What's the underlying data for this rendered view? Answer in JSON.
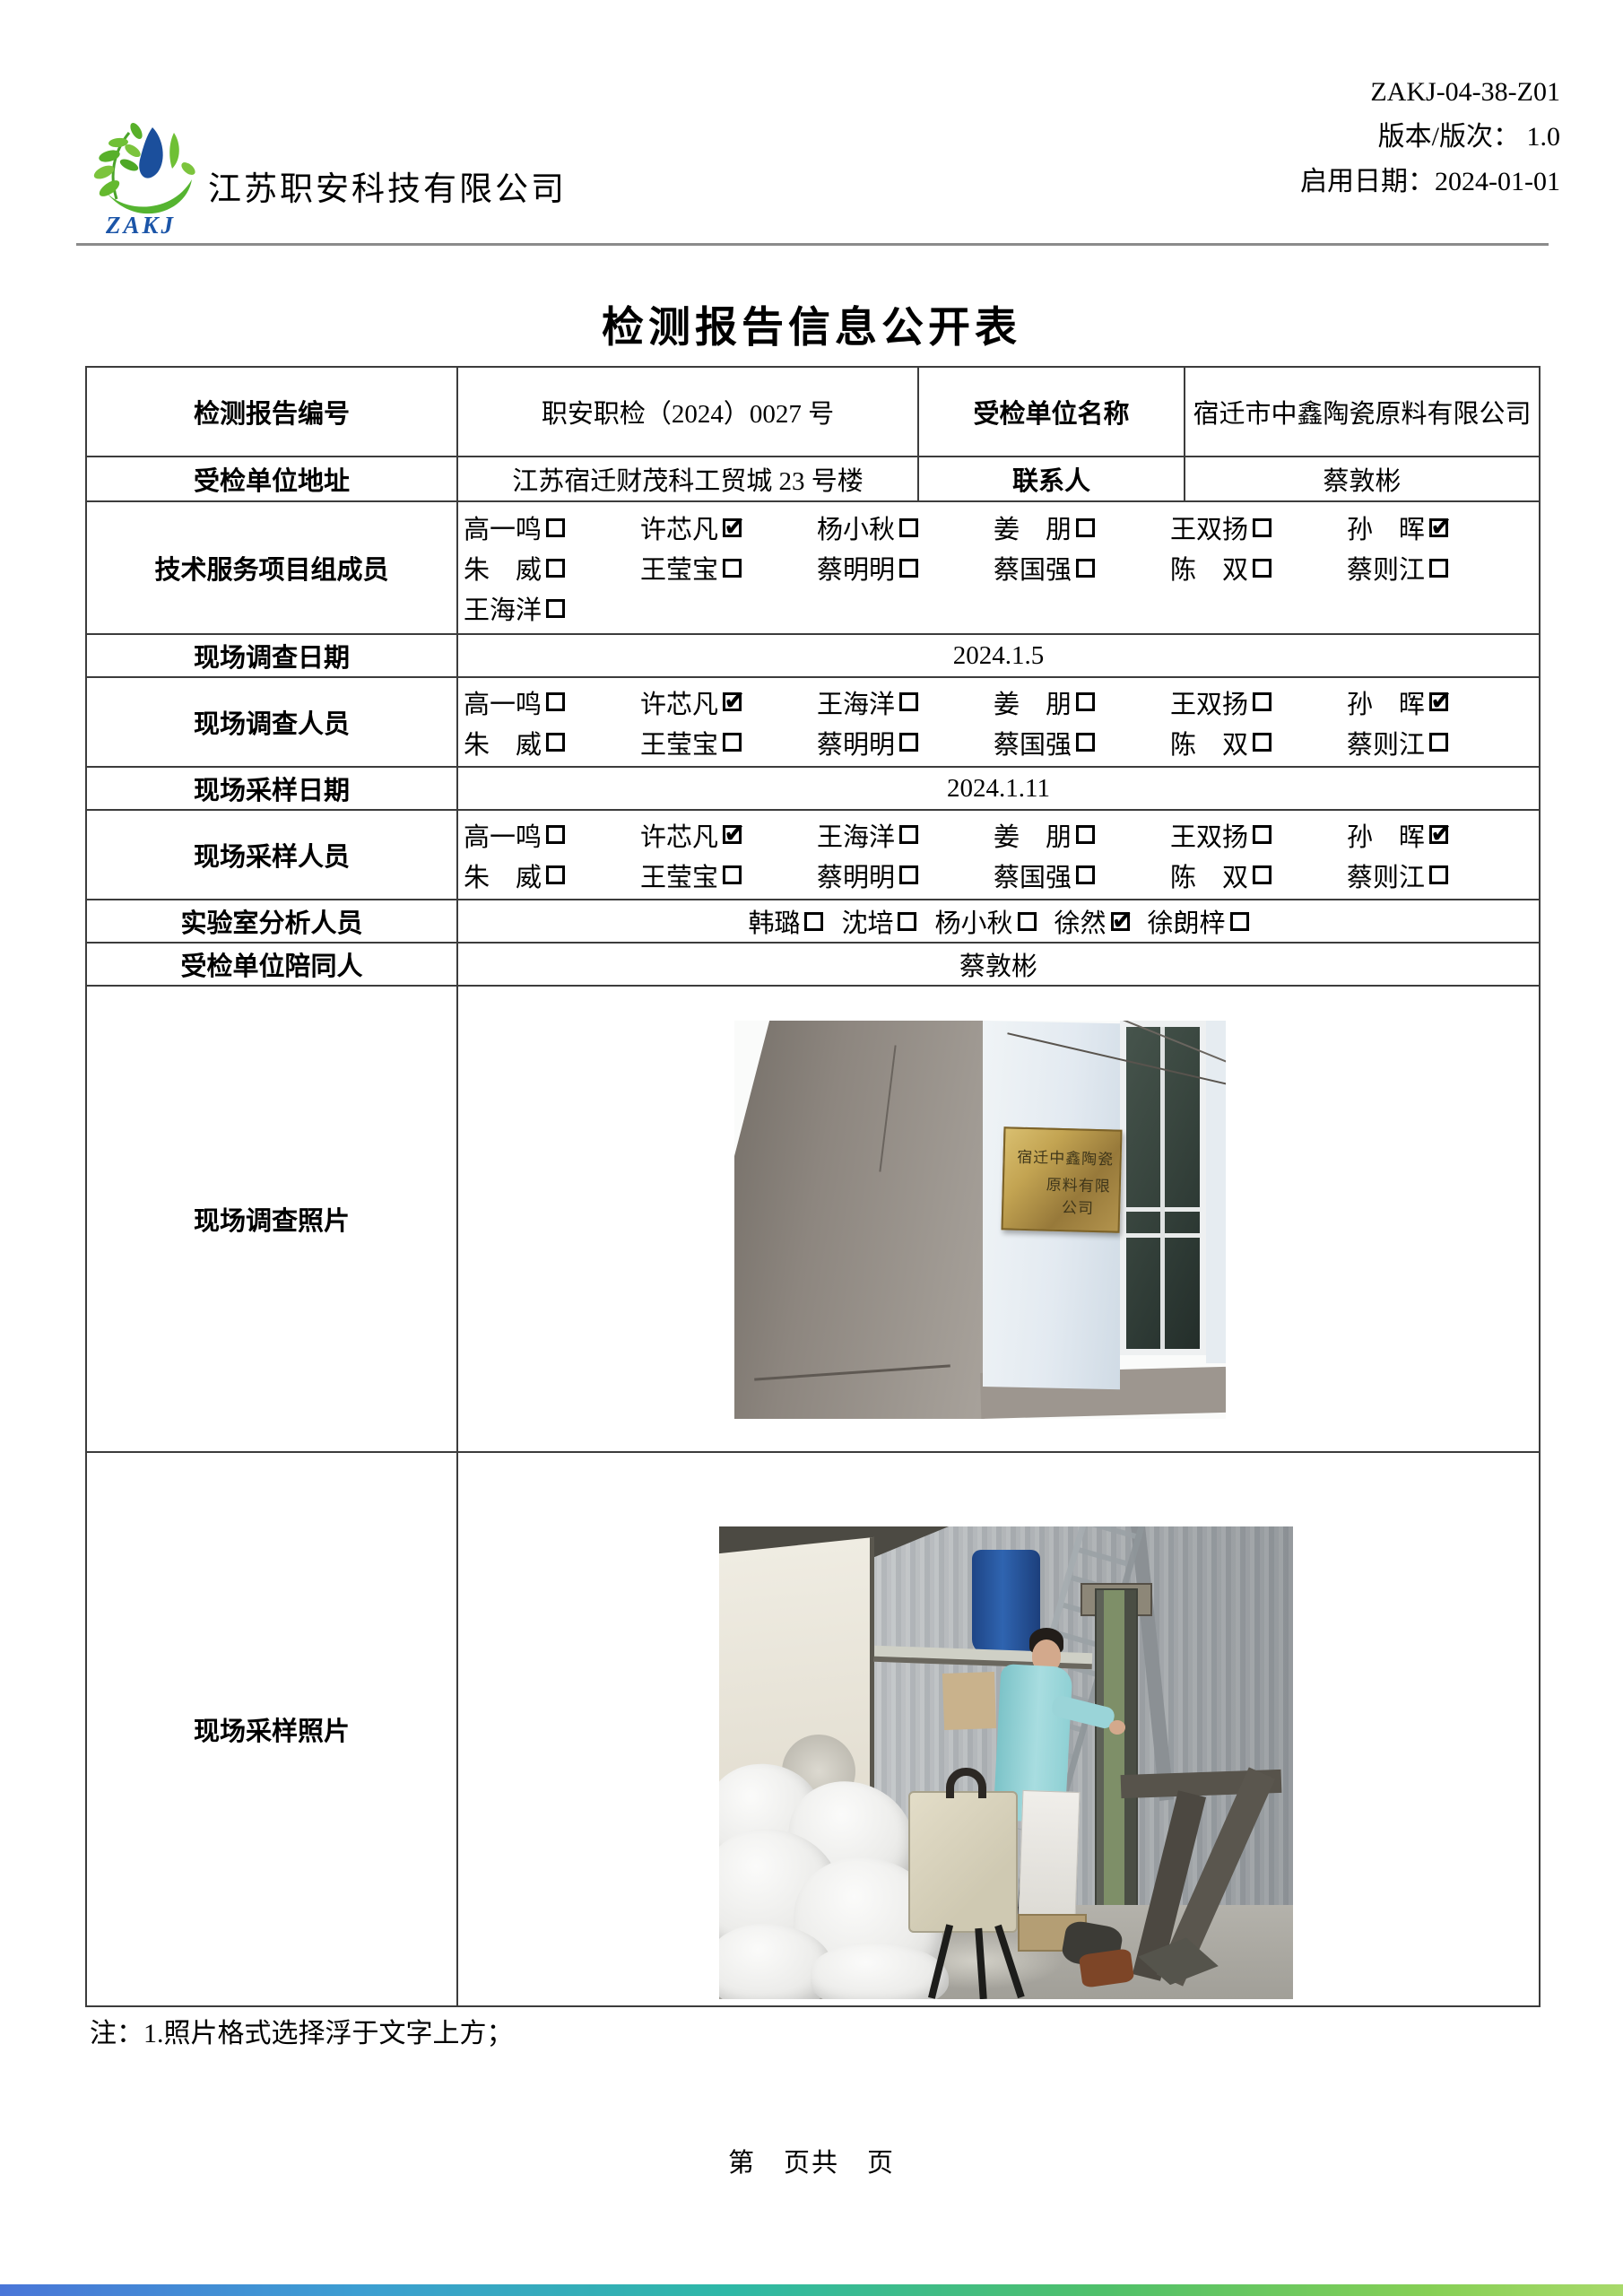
{
  "header": {
    "company_name": "江苏职安科技有限公司",
    "logo_text": "ZAKJ",
    "doc_code": "ZAKJ-04-38-Z01",
    "version_line": "版本/版次：  1.0",
    "date_line": "启用日期：2024-01-01"
  },
  "title": "检测报告信息公开表",
  "table": {
    "report_no_label": "检测报告编号",
    "report_no": "职安职检（2024）0027 号",
    "org_name_label": "受检单位名称",
    "org_name": "宿迁市中鑫陶瓷原料有限公司",
    "org_addr_label": "受检单位地址",
    "org_addr": "江苏宿迁财茂科工贸城 23 号楼",
    "contact_label": "联系人",
    "contact": "蔡敦彬",
    "team_label": "技术服务项目组成员",
    "team_lines": [
      [
        {
          "n": "高一鸣",
          "c": false
        },
        {
          "n": "许芯凡",
          "c": true
        },
        {
          "n": "杨小秋",
          "c": false
        },
        {
          "n": "姜　朋",
          "c": false
        },
        {
          "n": "王双扬",
          "c": false
        },
        {
          "n": "孙　晖",
          "c": true
        }
      ],
      [
        {
          "n": "朱　威",
          "c": false
        },
        {
          "n": "王莹宝",
          "c": false
        },
        {
          "n": "蔡明明",
          "c": false
        },
        {
          "n": "蔡国强",
          "c": false
        },
        {
          "n": "陈　双",
          "c": false
        },
        {
          "n": "蔡则江",
          "c": false
        }
      ],
      [
        {
          "n": "王海洋",
          "c": false
        }
      ]
    ],
    "survey_date_label": "现场调查日期",
    "survey_date": "2024.1.5",
    "survey_staff_label": "现场调查人员",
    "survey_staff_lines": [
      [
        {
          "n": "高一鸣",
          "c": false
        },
        {
          "n": "许芯凡",
          "c": true
        },
        {
          "n": "王海洋",
          "c": false
        },
        {
          "n": "姜　朋",
          "c": false
        },
        {
          "n": "王双扬",
          "c": false
        },
        {
          "n": "孙　晖",
          "c": true
        }
      ],
      [
        {
          "n": "朱　威",
          "c": false
        },
        {
          "n": "王莹宝",
          "c": false
        },
        {
          "n": "蔡明明",
          "c": false
        },
        {
          "n": "蔡国强",
          "c": false
        },
        {
          "n": "陈　双",
          "c": false
        },
        {
          "n": "蔡则江",
          "c": false
        }
      ]
    ],
    "sample_date_label": "现场采样日期",
    "sample_date": "2024.1.11",
    "sample_staff_label": "现场采样人员",
    "sample_staff_lines": [
      [
        {
          "n": "高一鸣",
          "c": false
        },
        {
          "n": "许芯凡",
          "c": true
        },
        {
          "n": "王海洋",
          "c": false
        },
        {
          "n": "姜　朋",
          "c": false
        },
        {
          "n": "王双扬",
          "c": false
        },
        {
          "n": "孙　晖",
          "c": true
        }
      ],
      [
        {
          "n": "朱　威",
          "c": false
        },
        {
          "n": "王莹宝",
          "c": false
        },
        {
          "n": "蔡明明",
          "c": false
        },
        {
          "n": "蔡国强",
          "c": false
        },
        {
          "n": "陈　双",
          "c": false
        },
        {
          "n": "蔡则江",
          "c": false
        }
      ]
    ],
    "lab_label": "实验室分析人员",
    "lab_lines": [
      [
        {
          "n": "韩璐",
          "c": false
        },
        {
          "n": "沈培",
          "c": false
        },
        {
          "n": "杨小秋",
          "c": false
        },
        {
          "n": "徐然",
          "c": true
        },
        {
          "n": "徐朗梓",
          "c": false
        }
      ]
    ],
    "escort_label": "受检单位陪同人",
    "escort": "蔡敦彬",
    "survey_photo_label": "现场调查照片",
    "sample_photo_label": "现场采样照片",
    "photo1_plaque_line1": "宿迁中鑫陶瓷",
    "photo1_plaque_line2": "原料有限公司"
  },
  "note": "注：1.照片格式选择浮于文字上方；",
  "footer": "第　页共　页",
  "colors": {
    "logo_green": "#5cb32c",
    "logo_blue": "#1b4f9c",
    "plaque_gold": "#b3913f",
    "coat_teal": "#8fd0d4",
    "barrel_blue": "#2d5fa9"
  }
}
